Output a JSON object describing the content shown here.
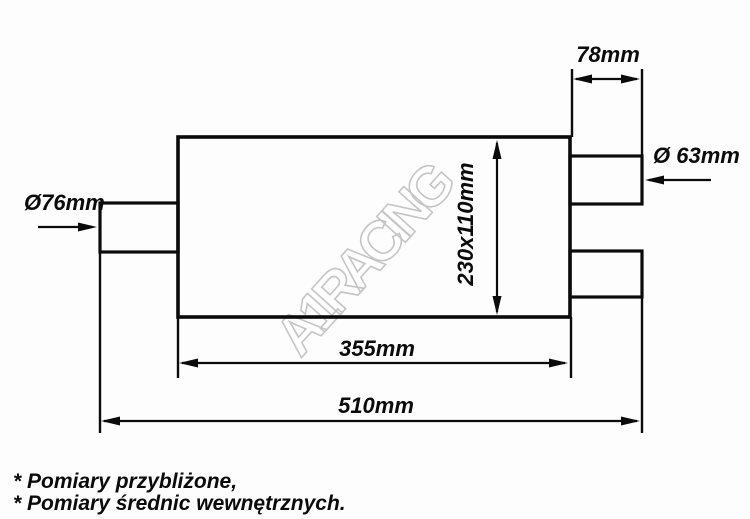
{
  "diagram": {
    "watermark": "A1RACING",
    "dimensions": {
      "outlet_stub_length": "78mm",
      "outlet_diameter": "Ø 63mm",
      "inlet_diameter": "Ø76mm",
      "body_cross_section": "230x110mm",
      "body_length": "355mm",
      "overall_length": "510mm"
    },
    "notes": [
      "* Pomiary przybliżone,",
      "* Pomiary średnic wewnętrznych."
    ],
    "colors": {
      "line": "#0b0b0b",
      "watermark_outline": "#c5c5c5",
      "background": "#fdfdfd"
    }
  }
}
